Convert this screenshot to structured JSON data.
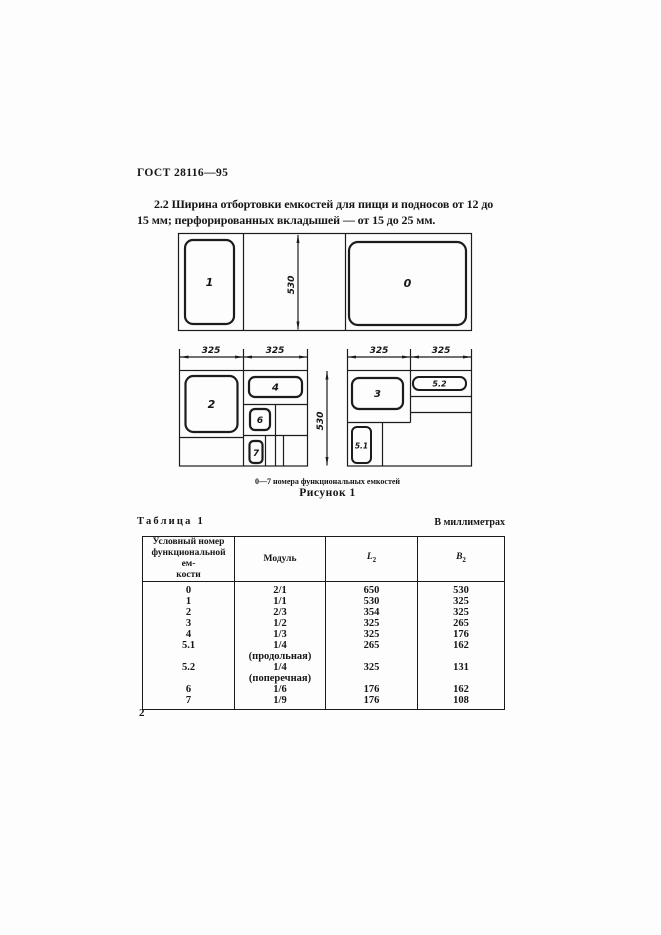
{
  "doc": {
    "code": "ГОСТ 28116—95",
    "para_lines": [
      "2.2 Ширина отбортовки емкостей для пищи и подносов от 12 до",
      "15 мм; перфорированных вкладышей — от 15 до 25 мм."
    ],
    "page_number": "2"
  },
  "figure": {
    "note": "0—7 номера функциональных емкостей",
    "caption": "Рисунок 1",
    "labels": {
      "c0": "0",
      "c1": "1",
      "c2": "2",
      "c3": "3",
      "c4": "4",
      "c51": "5.1",
      "c52": "5.2",
      "c6": "6",
      "c7": "7"
    },
    "dims": {
      "height": "530",
      "module": "325"
    }
  },
  "table": {
    "title": "Таблица 1",
    "units": "В миллиметрах",
    "headers": {
      "col1": "Условный номер\nфункциональной ем-\nкости",
      "col2": "Модуль",
      "col3_base": "L",
      "col3_sub": "2",
      "col4_base": "B",
      "col4_sub": "2"
    },
    "rows": [
      {
        "num": "0",
        "module": "2/1",
        "l": "650",
        "b": "530"
      },
      {
        "num": "1",
        "module": "1/1",
        "l": "530",
        "b": "325"
      },
      {
        "num": "2",
        "module": "2/3",
        "l": "354",
        "b": "325"
      },
      {
        "num": "3",
        "module": "1/2",
        "l": "325",
        "b": "265"
      },
      {
        "num": "4",
        "module": "1/3",
        "l": "325",
        "b": "176"
      },
      {
        "num": "5.1",
        "module": "1/4\n(продольная)",
        "l": "265",
        "b": "162"
      },
      {
        "num": "5.2",
        "module": "1/4\n(поперечная)",
        "l": "325",
        "b": "131"
      },
      {
        "num": "6",
        "module": "1/6",
        "l": "176",
        "b": "162"
      },
      {
        "num": "7",
        "module": "1/9",
        "l": "176",
        "b": "108"
      }
    ]
  }
}
